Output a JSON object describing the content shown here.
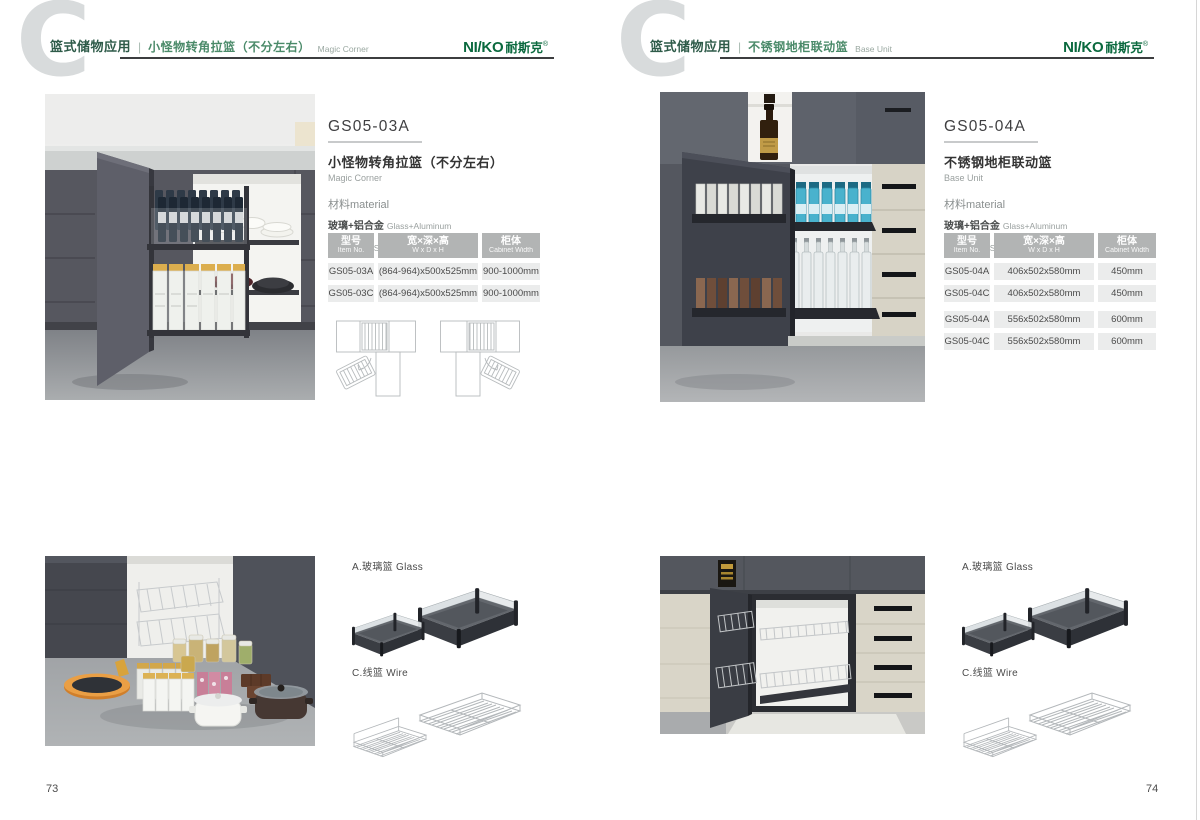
{
  "brand": {
    "text": "NI/KO",
    "cn": "耐斯克",
    "reg": "®"
  },
  "shared": {
    "divider": "|",
    "watermark": "C"
  },
  "colors": {
    "brand_green": "#0a693e",
    "category_green": "#2e5b49",
    "title_green": "#4a8a69",
    "rule_dark": "#3c3d3f",
    "table_header_bg": "#b2b4b4",
    "table_row_bg": "#ebecec",
    "watermark_gray": "#d8dbdc"
  },
  "pages": [
    {
      "page_number": "73",
      "header": {
        "category": "篮式储物应用",
        "title": "小怪物转角拉篮（不分左右）",
        "title_en": "Magic Corner"
      },
      "product": {
        "code": "GS05-03A",
        "name": "小怪物转角拉篮（不分左右）",
        "name_en": "Magic Corner",
        "material_heading": "材料material",
        "materials": [
          {
            "cn": "玻璃+铝合金",
            "en": "Glass+Aluminum"
          },
          {
            "cn": "不锈钢/铁",
            "en": "Stainless SteeL/Iron"
          }
        ]
      },
      "table": {
        "headers": [
          {
            "cn": "型号",
            "en": "Item No."
          },
          {
            "cn": "宽×深×高",
            "en": "W x D x H"
          },
          {
            "cn": "柜体",
            "en": "Cabinet Width"
          }
        ],
        "rows": [
          [
            "GS05-03A",
            "(864-964)x500x525mm",
            "900-1000mm"
          ],
          [
            "GS05-03C",
            "(864-964)x500x525mm",
            "900-1000mm"
          ]
        ]
      },
      "accessories": {
        "glass_label": "A.玻璃篮 Glass",
        "wire_label": "C.线篮 Wire"
      }
    },
    {
      "page_number": "74",
      "header": {
        "category": "篮式储物应用",
        "title": "不锈钢地柜联动篮",
        "title_en": "Base Unit"
      },
      "product": {
        "code": "GS05-04A",
        "name": "不锈钢地柜联动篮",
        "name_en": "Base Unit",
        "material_heading": "材料material",
        "materials": [
          {
            "cn": "玻璃+铝合金",
            "en": "Glass+Aluminum"
          },
          {
            "cn": "不锈钢/铁",
            "en": "Stainless SteeL/Iron"
          }
        ]
      },
      "table": {
        "headers": [
          {
            "cn": "型号",
            "en": "Item No."
          },
          {
            "cn": "宽×深×高",
            "en": "W x D x H"
          },
          {
            "cn": "柜体",
            "en": "Cabinet Width"
          }
        ],
        "rows": [
          [
            "GS05-04A",
            "406x502x580mm",
            "450mm"
          ],
          [
            "GS05-04C",
            "406x502x580mm",
            "450mm"
          ],
          [
            "GS05-04A",
            "556x502x580mm",
            "600mm"
          ],
          [
            "GS05-04C",
            "556x502x580mm",
            "600mm"
          ]
        ]
      },
      "accessories": {
        "glass_label": "A.玻璃篮 Glass",
        "wire_label": "C.线篮 Wire"
      }
    }
  ]
}
